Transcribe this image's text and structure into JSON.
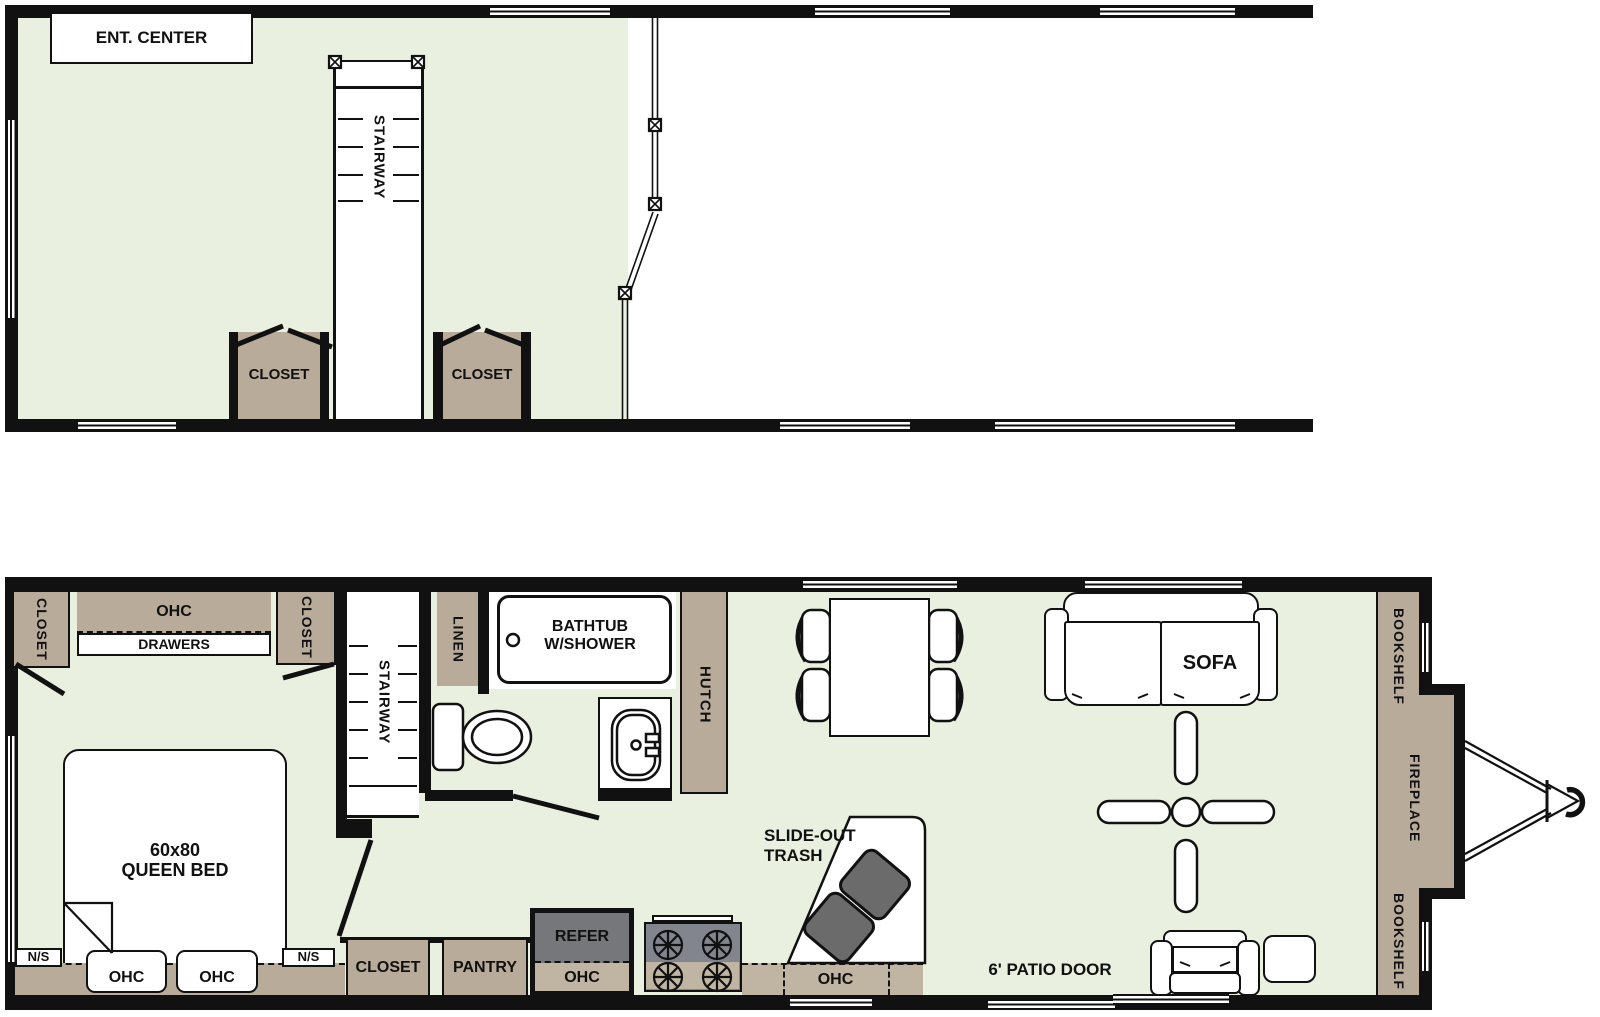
{
  "title_hint": "Two-level park model travel trailer floor plan",
  "colors": {
    "wall": "#111111",
    "floor_green": "#e9f0e0",
    "cabinet_tan": "#b8ab9a",
    "cabinet_tan_light": "#c0b4a2",
    "appliance_gray": "#76777b",
    "stove_gray": "#83858e",
    "trash_gray": "#6b6b6b",
    "white": "#ffffff"
  },
  "upper_floor": {
    "ent_center": "ENT. CENTER",
    "stairway": "STAIRWAY",
    "closet_left": "CLOSET",
    "closet_right": "CLOSET"
  },
  "main_floor": {
    "bedroom": {
      "closet_top_left": "CLOSET",
      "ohc_top": "OHC",
      "drawers": "DRAWERS",
      "closet_top_right": "CLOSET",
      "bed_line1": "60x80",
      "bed_line2": "QUEEN BED",
      "nightstand_left": "N/S",
      "nightstand_right": "N/S",
      "ohc_bottom_1": "OHC",
      "ohc_bottom_2": "OHC",
      "stairway": "STAIRWAY"
    },
    "bath": {
      "linen": "LINEN",
      "bathtub_line1": "BATHTUB",
      "bathtub_line2": "W/SHOWER",
      "hutch": "HUTCH"
    },
    "kitchen": {
      "closet": "CLOSET",
      "pantry": "PANTRY",
      "refer": "REFER",
      "refer_ohc": "OHC",
      "ohc": "OHC",
      "slideout_line1": "SLIDE-OUT",
      "slideout_line2": "TRASH"
    },
    "living": {
      "sofa": "SOFA",
      "patio_door": "6' PATIO DOOR",
      "bookshelf_top": "BOOKSHELF",
      "fireplace": "FIREPLACE",
      "bookshelf_bottom": "BOOKSHELF"
    }
  }
}
